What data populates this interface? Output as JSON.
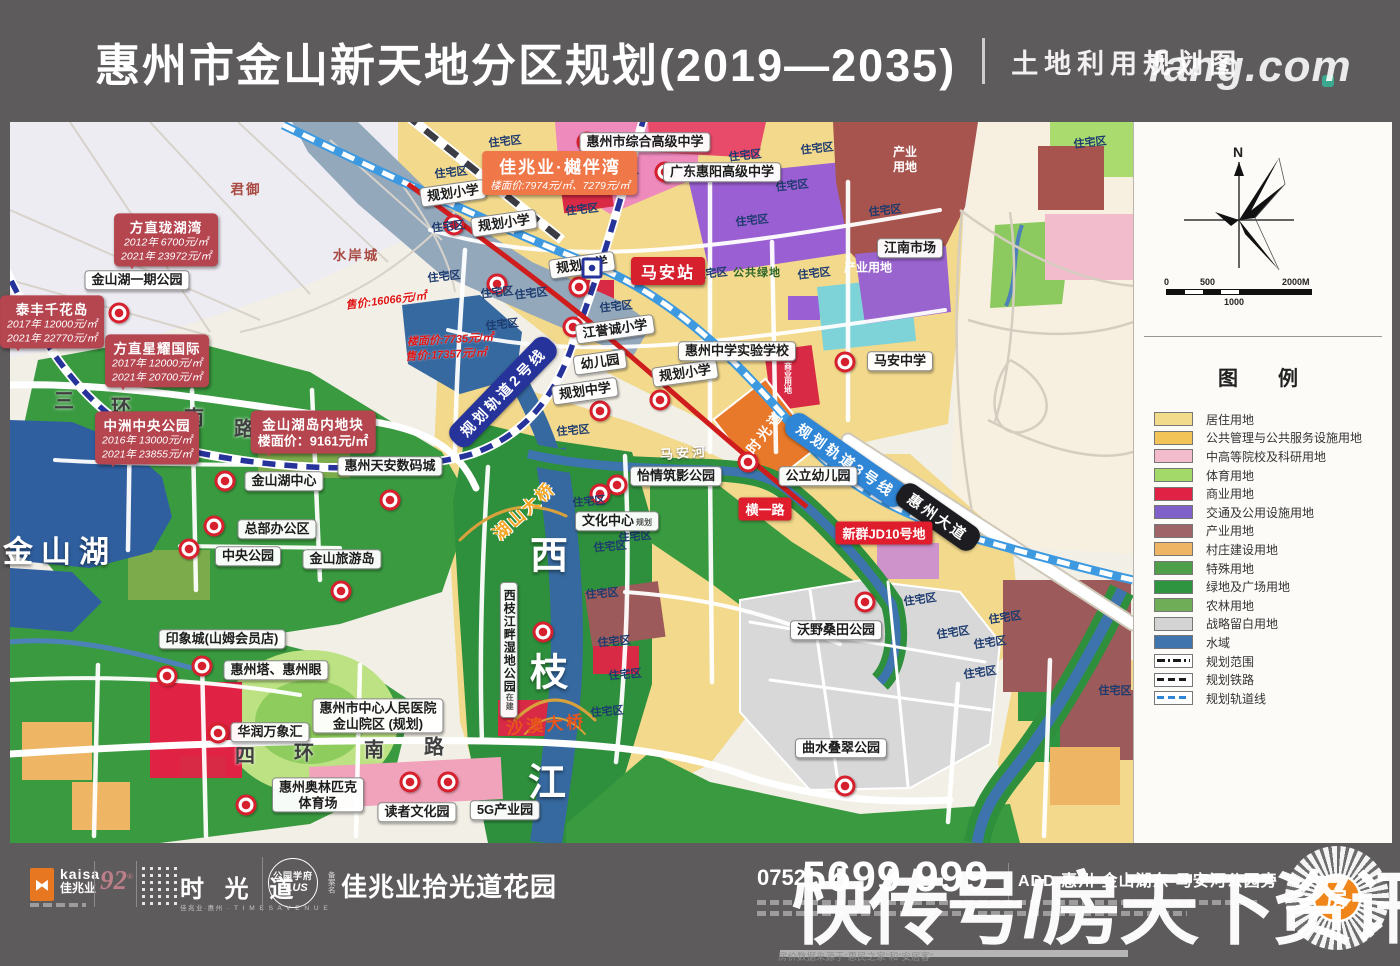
{
  "header": {
    "title": "惠州市金山新天地分区规划(2019—2035)",
    "subtitle": "土地利用规划图"
  },
  "panel": {
    "north_label": "N",
    "scale_ticks": [
      "0",
      "500",
      "1000",
      "2000M"
    ],
    "legend_title": "图　例",
    "legend": [
      {
        "label": "居住用地",
        "color": "#f2dc8b",
        "kind": "fill"
      },
      {
        "label": "公共管理与公共服务设施用地",
        "color": "#f2c357",
        "kind": "fill"
      },
      {
        "label": "中高等院校及科研用地",
        "color": "#f2bccd",
        "kind": "fill"
      },
      {
        "label": "体育用地",
        "color": "#a2d968",
        "kind": "fill"
      },
      {
        "label": "商业用地",
        "color": "#e02345",
        "kind": "fill"
      },
      {
        "label": "交通及公用设施用地",
        "color": "#7f5fc8",
        "kind": "fill"
      },
      {
        "label": "产业用地",
        "color": "#9f6468",
        "kind": "fill"
      },
      {
        "label": "村庄建设用地",
        "color": "#eeb565",
        "kind": "fill"
      },
      {
        "label": "特殊用地",
        "color": "#4f9f4a",
        "kind": "fill"
      },
      {
        "label": "绿地及广场用地",
        "color": "#2f9440",
        "kind": "fill"
      },
      {
        "label": "农林用地",
        "color": "#6fae57",
        "kind": "fill"
      },
      {
        "label": "战略留白用地",
        "color": "#d3d3d3",
        "kind": "fill"
      },
      {
        "label": "水域",
        "color": "#3f74ad",
        "kind": "fill"
      },
      {
        "label": "规划范围",
        "color": "#1a1a1a",
        "kind": "dashdot"
      },
      {
        "label": "规划铁路",
        "color": "#1a1a1a",
        "kind": "dash"
      },
      {
        "label": "规划轨道线",
        "color": "#2f86d6",
        "kind": "dashblue"
      }
    ]
  },
  "map": {
    "station": {
      "label": "马安站",
      "x": 668,
      "y": 271,
      "icon_x": 592,
      "icon_y": 268
    },
    "banners": [
      {
        "t": "规划轨道2号线",
        "x": 503,
        "y": 392,
        "r": -46,
        "bg": "#26339a"
      },
      {
        "t": "规划轨道3号线",
        "x": 846,
        "y": 460,
        "r": 35,
        "bg": "#2f86d6"
      },
      {
        "t": "惠州大道",
        "x": 938,
        "y": 517,
        "r": 35,
        "bg": "#1d1d21"
      }
    ],
    "red_boxes": [
      {
        "t": "横一路",
        "x": 765,
        "y": 509
      },
      {
        "t": "新群JD10号地",
        "x": 884,
        "y": 533
      }
    ],
    "orange_callout": {
      "title": "佳兆业·樾伴湾",
      "line": "楼面价:7974元/㎡、7279元/㎡",
      "x": 560,
      "y": 173
    },
    "red_callouts": [
      {
        "title": "方直珑湖湾",
        "lines": [
          "2012年 6700元/㎡",
          "2021年 23972元/㎡"
        ],
        "x": 166,
        "y": 240
      },
      {
        "title": "泰丰千花岛",
        "lines": [
          "2017年 12000元/㎡",
          "2021年 22770元/㎡"
        ],
        "x": 52,
        "y": 322
      },
      {
        "title": "方直星耀国际",
        "lines": [
          "2017年 12000元/㎡",
          "2021年 20700元/㎡"
        ],
        "x": 157,
        "y": 361
      },
      {
        "title": "中洲中央公园",
        "lines": [
          "2016年 13000元/㎡",
          "2021年 23855元/㎡"
        ],
        "x": 147,
        "y": 438
      },
      {
        "title": "金山湖岛内地块",
        "big_line": "楼面价：9161元/㎡",
        "x": 313,
        "y": 432
      }
    ],
    "white_labels": [
      {
        "t": "金山湖一期公园",
        "x": 137,
        "y": 280
      },
      {
        "t": "规划小学",
        "x": 453,
        "y": 193,
        "r": -8
      },
      {
        "t": "规划小学",
        "x": 504,
        "y": 223,
        "r": -8
      },
      {
        "t": "规划小学",
        "x": 582,
        "y": 265,
        "r": -8
      },
      {
        "t": "规划小学",
        "x": 685,
        "y": 373,
        "r": -8
      },
      {
        "t": "规划中学",
        "x": 585,
        "y": 391,
        "r": -8
      },
      {
        "t": "幼儿园",
        "x": 600,
        "y": 362,
        "r": -8
      },
      {
        "t": "江誉诚小学",
        "x": 615,
        "y": 329,
        "r": -8
      },
      {
        "t": "惠州市综合高级中学",
        "x": 645,
        "y": 142
      },
      {
        "t": "广东惠阳高级中学",
        "x": 722,
        "y": 172
      },
      {
        "t": "惠州中学实验学校",
        "x": 737,
        "y": 351
      },
      {
        "t": "马安中学",
        "x": 900,
        "y": 361
      },
      {
        "t": "江南市场",
        "x": 910,
        "y": 248
      },
      {
        "t": "惠州天安数码城",
        "x": 390,
        "y": 466
      },
      {
        "t": "金山湖中心",
        "x": 284,
        "y": 481
      },
      {
        "t": "总部办公区",
        "x": 277,
        "y": 529
      },
      {
        "t": "中央公园",
        "x": 248,
        "y": 556
      },
      {
        "t": "金山旅游岛",
        "x": 342,
        "y": 559
      },
      {
        "t": "印象城(山姆会员店)",
        "x": 222,
        "y": 639
      },
      {
        "t": "惠州塔、惠州眼",
        "x": 276,
        "y": 670
      },
      {
        "t": "华润万象汇",
        "x": 270,
        "y": 732
      },
      {
        "t": "惠州市中心人民医院",
        "t2": "金山院区 (规划)",
        "x": 378,
        "y": 716
      },
      {
        "t": "惠州奥林匹克",
        "t2": "体育场",
        "x": 318,
        "y": 795
      },
      {
        "t": "读者文化园",
        "x": 417,
        "y": 812
      },
      {
        "t": "5G产业园",
        "x": 505,
        "y": 810
      },
      {
        "t": "怡情筑影公园",
        "x": 676,
        "y": 476
      },
      {
        "t": "公立幼儿园",
        "x": 818,
        "y": 476
      },
      {
        "t": "文化中心",
        "suffix": "规划",
        "x": 617,
        "y": 521
      },
      {
        "t": "沃野桑田公园",
        "x": 836,
        "y": 630
      },
      {
        "t": "曲水叠翠公园",
        "x": 841,
        "y": 748
      },
      {
        "t": "西枝江畔湿地公园",
        "suffix": "在建",
        "x": 509,
        "y": 650,
        "vert": true
      }
    ],
    "texts": [
      {
        "t": "君御",
        "x": 246,
        "y": 188,
        "k": "maroontext"
      },
      {
        "t": "水岸城",
        "x": 356,
        "y": 254,
        "k": "maroontext"
      },
      {
        "t": "金山湖",
        "x": 60,
        "y": 549,
        "k": "lake"
      },
      {
        "t": "西",
        "x": 549,
        "y": 552,
        "k": "bigriver"
      },
      {
        "t": "枝",
        "x": 549,
        "y": 669,
        "k": "bigriver"
      },
      {
        "t": "江",
        "x": 547,
        "y": 779,
        "k": "bigriver"
      },
      {
        "t": "马安河",
        "x": 684,
        "y": 452,
        "k": "rivertext",
        "r": -4
      },
      {
        "t": "三",
        "x": 64,
        "y": 399,
        "k": "road"
      },
      {
        "t": "环",
        "x": 121,
        "y": 405,
        "k": "road"
      },
      {
        "t": "南",
        "x": 194,
        "y": 416,
        "k": "road"
      },
      {
        "t": "路",
        "x": 244,
        "y": 427,
        "k": "road"
      },
      {
        "t": "四",
        "x": 245,
        "y": 754,
        "k": "road"
      },
      {
        "t": "环",
        "x": 304,
        "y": 751,
        "k": "road"
      },
      {
        "t": "南",
        "x": 374,
        "y": 748,
        "k": "road"
      },
      {
        "t": "路",
        "x": 434,
        "y": 745,
        "k": "road"
      },
      {
        "t": "产业\n用地",
        "x": 905,
        "y": 160,
        "k": "areawhite"
      },
      {
        "t": "产业用地",
        "x": 868,
        "y": 268,
        "k": "areawhite"
      },
      {
        "t": "公共绿地",
        "x": 757,
        "y": 272,
        "k": "greentext"
      },
      {
        "t": "商业用地",
        "x": 788,
        "y": 378,
        "k": "vtiny"
      },
      {
        "t": "售价:16066元/㎡",
        "x": 386,
        "y": 300,
        "k": "redit",
        "r": -7
      },
      {
        "t": "楼面价:7735元/㎡",
        "x": 450,
        "y": 339,
        "k": "redit",
        "r": -3
      },
      {
        "t": "售价:17357元/㎡",
        "x": 446,
        "y": 354,
        "k": "redit",
        "r": -3
      },
      {
        "t": "湖山大桥",
        "x": 523,
        "y": 510,
        "k": "bridgeorange",
        "r": -42
      },
      {
        "t": "沙澳大桥",
        "x": 546,
        "y": 723,
        "k": "bridgered",
        "r": -5
      },
      {
        "t": "时光道",
        "x": 765,
        "y": 432,
        "k": "blocktext",
        "r": -52
      },
      {
        "t": "住宅区",
        "x": 505,
        "y": 141,
        "k": "res",
        "r": -6
      },
      {
        "t": "住宅区",
        "x": 622,
        "y": 171,
        "k": "res",
        "r": -6
      },
      {
        "t": "住宅区",
        "x": 582,
        "y": 209,
        "k": "res",
        "r": -6
      },
      {
        "t": "住宅区",
        "x": 451,
        "y": 172,
        "k": "res",
        "r": -6
      },
      {
        "t": "住宅区",
        "x": 448,
        "y": 226,
        "k": "res",
        "r": -6
      },
      {
        "t": "住宅区",
        "x": 444,
        "y": 276,
        "k": "res",
        "r": -6
      },
      {
        "t": "住宅区",
        "x": 497,
        "y": 292,
        "k": "res",
        "r": -6
      },
      {
        "t": "住宅区",
        "x": 531,
        "y": 293,
        "k": "res",
        "r": -6
      },
      {
        "t": "住宅区",
        "x": 502,
        "y": 324,
        "k": "res",
        "r": -6
      },
      {
        "t": "住宅区",
        "x": 616,
        "y": 306,
        "k": "res",
        "r": -6
      },
      {
        "t": "住宅区",
        "x": 711,
        "y": 273,
        "k": "res",
        "r": -6
      },
      {
        "t": "住宅区",
        "x": 814,
        "y": 273,
        "k": "res",
        "r": -6
      },
      {
        "t": "住宅区",
        "x": 745,
        "y": 155,
        "k": "res",
        "r": -6
      },
      {
        "t": "住宅区",
        "x": 752,
        "y": 220,
        "k": "res",
        "r": -6
      },
      {
        "t": "住宅区",
        "x": 792,
        "y": 185,
        "k": "res",
        "r": -6
      },
      {
        "t": "住宅区",
        "x": 817,
        "y": 148,
        "k": "res",
        "r": -6
      },
      {
        "t": "住宅区",
        "x": 885,
        "y": 210,
        "k": "res",
        "r": -6
      },
      {
        "t": "住宅区",
        "x": 1090,
        "y": 142,
        "k": "res",
        "r": -6
      },
      {
        "t": "住宅区",
        "x": 573,
        "y": 430,
        "k": "res",
        "r": -5
      },
      {
        "t": "住宅区",
        "x": 589,
        "y": 501,
        "k": "res",
        "r": -5
      },
      {
        "t": "住宅区",
        "x": 635,
        "y": 536,
        "k": "res",
        "r": -5
      },
      {
        "t": "住宅区",
        "x": 610,
        "y": 546,
        "k": "res",
        "r": -5
      },
      {
        "t": "住宅区",
        "x": 602,
        "y": 593,
        "k": "res",
        "r": -5
      },
      {
        "t": "住宅区",
        "x": 614,
        "y": 641,
        "k": "res",
        "r": -5
      },
      {
        "t": "住宅区",
        "x": 625,
        "y": 674,
        "k": "res",
        "r": -5
      },
      {
        "t": "住宅区",
        "x": 607,
        "y": 711,
        "k": "res",
        "r": -5
      },
      {
        "t": "住宅区",
        "x": 920,
        "y": 599,
        "k": "res",
        "r": -8
      },
      {
        "t": "住宅区",
        "x": 1005,
        "y": 617,
        "k": "res",
        "r": -8
      },
      {
        "t": "住宅区",
        "x": 953,
        "y": 632,
        "k": "res",
        "r": -8
      },
      {
        "t": "住宅区",
        "x": 990,
        "y": 642,
        "k": "res",
        "r": -8
      },
      {
        "t": "住宅区",
        "x": 980,
        "y": 672,
        "k": "res",
        "r": -8
      },
      {
        "t": "住宅区",
        "x": 1115,
        "y": 690,
        "k": "res"
      }
    ],
    "markers": [
      [
        119,
        313
      ],
      [
        454,
        225
      ],
      [
        497,
        284
      ],
      [
        579,
        287
      ],
      [
        573,
        327
      ],
      [
        600,
        411
      ],
      [
        660,
        400
      ],
      [
        587,
        142
      ],
      [
        665,
        172
      ],
      [
        845,
        362
      ],
      [
        748,
        462
      ],
      [
        617,
        485
      ],
      [
        600,
        494
      ],
      [
        225,
        481
      ],
      [
        214,
        526
      ],
      [
        189,
        549
      ],
      [
        341,
        591
      ],
      [
        390,
        500
      ],
      [
        167,
        676
      ],
      [
        202,
        666
      ],
      [
        218,
        733
      ],
      [
        246,
        805
      ],
      [
        410,
        782
      ],
      [
        448,
        782
      ],
      [
        543,
        632
      ],
      [
        865,
        602
      ],
      [
        845,
        786
      ]
    ],
    "note_lines": [
      "湖山大桥、沙澳大桥规划出自《惠州市金山新城湖山片区控制性详细规划调整论证报告及调整草案》",
      "房价数据来源于“惠民之家”和“安居客”"
    ]
  },
  "footer": {
    "kaisa_en": "kaisa",
    "kaisa_cn": "佳兆业",
    "anniversary": "92",
    "avenue_cn": "时 光 道",
    "avenue_sub": "佳兆业·惠州 · T I M E S A V E N U E",
    "badge_line1": "公园学府",
    "badge_line2": "PLUS",
    "project_prefix": "备案名",
    "project_name": "佳兆业拾光道花园",
    "phone_code": "0752",
    "phone_number": "5699 999",
    "address": "ADD 惠州·金山湖东·马安河公园旁",
    "qr_glyph": "房"
  },
  "watermark": {
    "main": "快传号/房天下资讯",
    "sub": "fang.com"
  }
}
